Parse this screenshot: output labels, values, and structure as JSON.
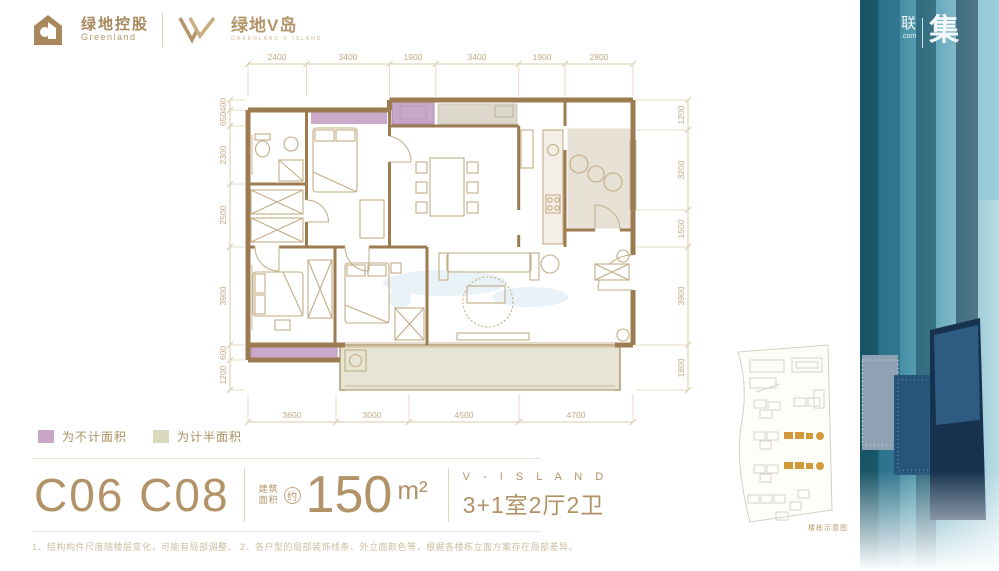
{
  "header": {
    "greenland": {
      "cn": "绿地控股",
      "en": "Greenland"
    },
    "visland": {
      "cn": "绿地V岛",
      "sub": "GREENLAND V ISLAND"
    }
  },
  "watermark": {
    "cn_small": "联",
    "domain": ".com",
    "cn_big": "集"
  },
  "side_band": {
    "vertical_text": "V-ISLAND"
  },
  "floor_plan": {
    "dimensions": {
      "top": [
        "2400",
        "3400",
        "1900",
        "3400",
        "1900",
        "2800"
      ],
      "bottom": [
        "3600",
        "3000",
        "4500",
        "4700"
      ],
      "left": [
        "400",
        "650",
        "2300",
        "2500",
        "3900",
        "600",
        "1200"
      ],
      "right": [
        "1200",
        "3200",
        "1500",
        "3900",
        "1800"
      ]
    }
  },
  "legend": {
    "items": [
      {
        "label": "为不计面积",
        "color": "#c9a6c5"
      },
      {
        "label": "为计半面积",
        "color": "#d9dabd"
      }
    ]
  },
  "summary": {
    "unit_code": "C06 C08",
    "area_label_line1": "建筑",
    "area_label_line2": "面积",
    "approx": "约",
    "area_value": "150",
    "area_unit": "m²",
    "project_name": "V - I S L A N D",
    "layout": "3+1室2厅2卫"
  },
  "sitemap": {
    "caption": "楼栋示意图"
  },
  "disclaimer": "1、结构构件尺度随楼层变化，可能有局部调整。  2、各户型的局部装饰线条、外立面颜色等，根据各楼栋立面方案存在局部差异。",
  "colors": {
    "accent_gold": "#b29267",
    "wall_brown": "#9c7b50",
    "no_area_purple": "#c9a6c5",
    "half_area_green": "#d9dabd",
    "band_teal": "#2e7d96"
  }
}
